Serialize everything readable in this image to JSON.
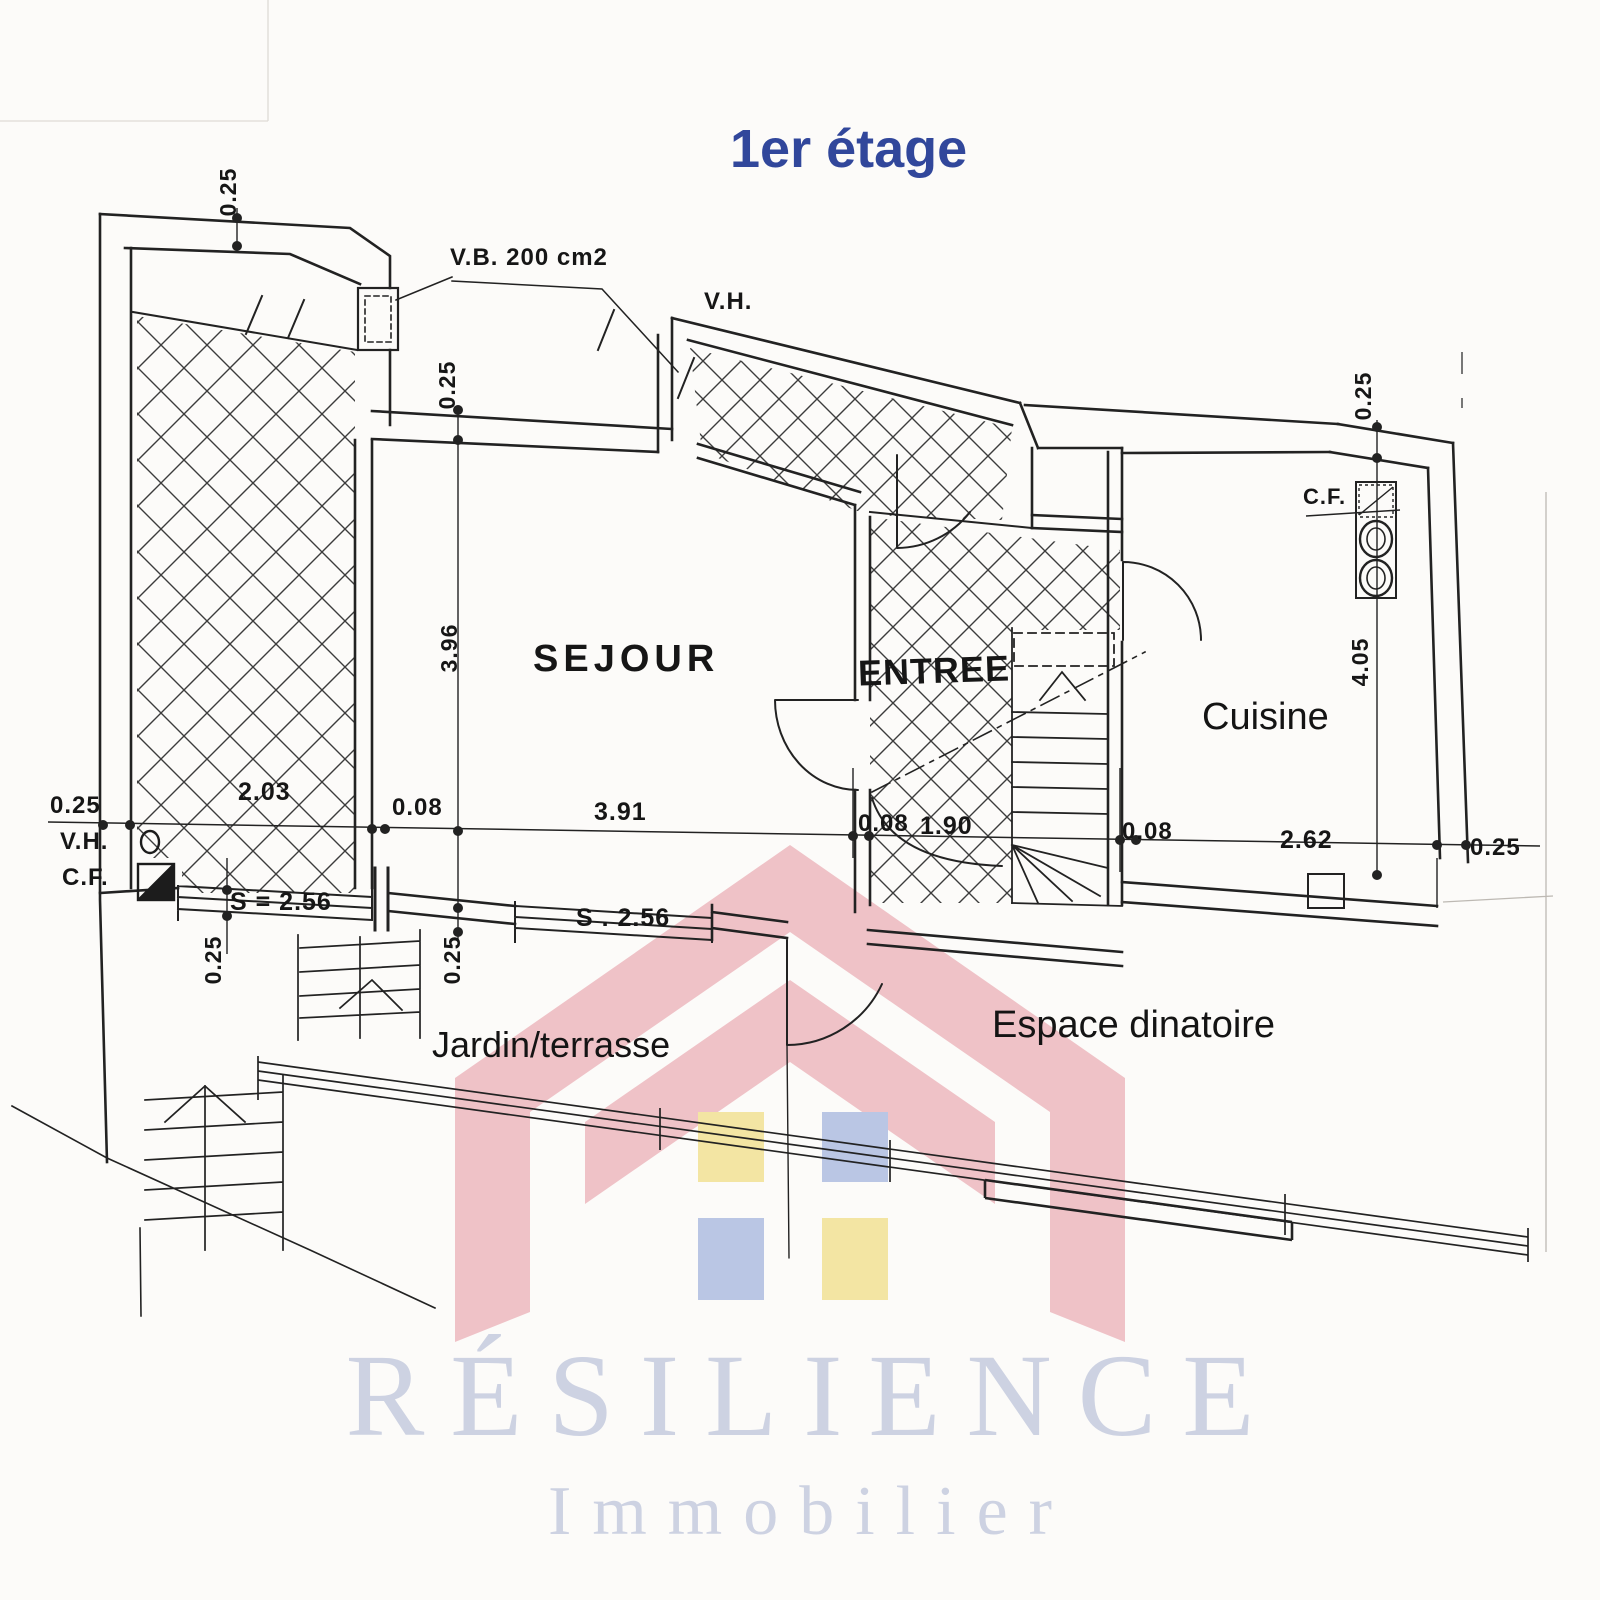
{
  "title": "1er étage",
  "rooms": {
    "sejour": "SEJOUR",
    "entree": "ENTREE",
    "cuisine": "Cuisine",
    "jardin": "Jardin/terrasse",
    "espace": "Espace dinatoire"
  },
  "annotations": {
    "vent": "V.B. 200 cm2",
    "vh_top": "V.H.",
    "vh_left": "V.H.",
    "cf_left": "C.F.",
    "cf_right": "C.F.",
    "window_a_area": "S = 2.56",
    "window_b_area": "S . 2.56"
  },
  "dims": {
    "wall_top_left": "0.25",
    "wall_sejour_top": "0.25",
    "wall_top_right": "0.25",
    "wall_left": "0.25",
    "wall_right": "0.25",
    "terrace_width": "2.03",
    "partition_a": "0.08",
    "sejour_width": "3.91",
    "partition_b": "0.08",
    "stair_width": "1.90",
    "partition_c": "0.08",
    "cuisine_width": "2.62",
    "sejour_depth": "3.96",
    "cuisine_depth": "4.05",
    "sill_a": "0.25",
    "sill_b": "0.25"
  },
  "brand": {
    "name": "RÉSILIENCE",
    "tagline": "Immobilier"
  },
  "colors": {
    "title": "#31479b",
    "ink": "#1f1f1f",
    "paper": "#fcfbf9",
    "watermark_pink": "#efc2c7",
    "watermark_yellow": "#f3e5a3",
    "watermark_blue": "#bac6e4",
    "brand_text": "#cdd2e2"
  }
}
